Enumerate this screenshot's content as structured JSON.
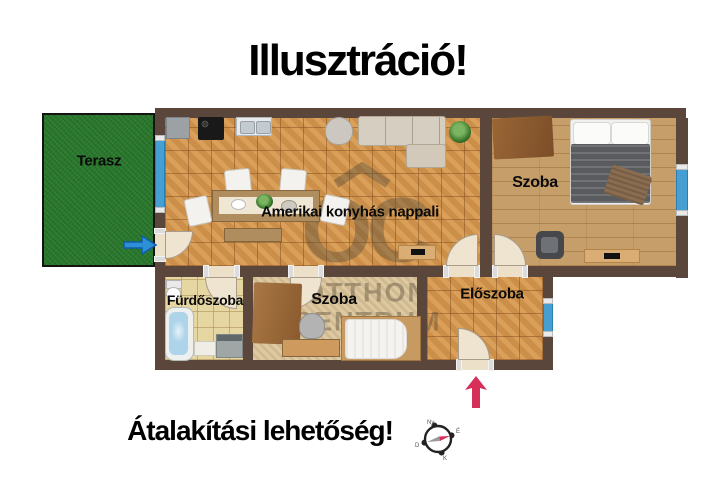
{
  "title": "Illusztráció!",
  "caption": "Átalakítási lehetőség!",
  "rooms": {
    "terasz": {
      "label": "Terasz"
    },
    "nappali": {
      "label": "Amerikai konyhás nappali"
    },
    "szoba_nagy": {
      "label": "Szoba"
    },
    "furdoszoba": {
      "label": "Fürdőszoba"
    },
    "szoba_kicsi": {
      "label": "Szoba"
    },
    "eloszoba": {
      "label": "Előszoba"
    }
  },
  "watermark": {
    "logo": "OC",
    "line1": "OTTHON",
    "line2": "CENTRUM"
  },
  "compass": {
    "north": "É",
    "east": "K",
    "south": "D",
    "west": "Ny"
  },
  "colors": {
    "wall": "#5a463a",
    "tile_floor": "#d2954e",
    "wood_floor": "#c69e6a",
    "bath_tile": "#e5d6a2",
    "carpet": "#d9c399",
    "terrace_green": "#2a7a2e",
    "window_blue": "#459fd2",
    "arrow_blue": "#2f8fd4",
    "arrow_pink": "#d63058"
  }
}
